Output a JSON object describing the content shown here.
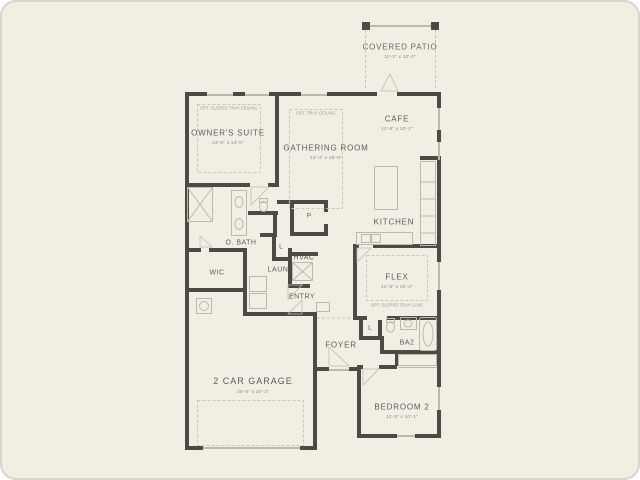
{
  "plan": {
    "type": "floor-plan",
    "colors": {
      "background": "#f1eee4",
      "wall": "#4b4a44",
      "light_line": "#bcb8ab",
      "dashed_line": "#c9c5b8",
      "label_text": "#5d5c55"
    }
  },
  "rooms": {
    "covered_patio": {
      "name": "COVERED PATIO",
      "dim": "11'-1\" x 10'-0\""
    },
    "owners_suite": {
      "name": "OWNER'S SUITE",
      "dim": "13'-0\" x 14'-0\"",
      "note": "OPT. SLOPED TRAY CEILING"
    },
    "gathering_room": {
      "name": "GATHERING ROOM",
      "dim": "12'-4\" x 18'-0\"",
      "note": "OPT. TRAY CEILING"
    },
    "cafe": {
      "name": "CAFE",
      "dim": "12'-8\" x 10'-2\""
    },
    "kitchen": {
      "name": "KITCHEN"
    },
    "owners_bath": {
      "name": "O. BATH"
    },
    "wic": {
      "name": "WIC"
    },
    "laundry": {
      "name": "LAUN"
    },
    "hvac": {
      "name": "HVAC"
    },
    "entry": {
      "name": "ENTRY"
    },
    "pantry": {
      "name": "P"
    },
    "linen_hall": {
      "name": "L"
    },
    "linen_ba2": {
      "name": "L"
    },
    "foyer": {
      "name": "FOYER"
    },
    "bath2": {
      "name": "BA2"
    },
    "flex": {
      "name": "FLEX",
      "dim": "12'-6\" x 10'-2\"",
      "note": "OPT. SLOPED TRAY CLNG"
    },
    "bedroom2": {
      "name": "BEDROOM 2",
      "dim": "11'-9\" x 10'-1\""
    },
    "garage": {
      "name": "2 CAR GARAGE",
      "dim": "20'-0\" x 20'-3\""
    }
  }
}
